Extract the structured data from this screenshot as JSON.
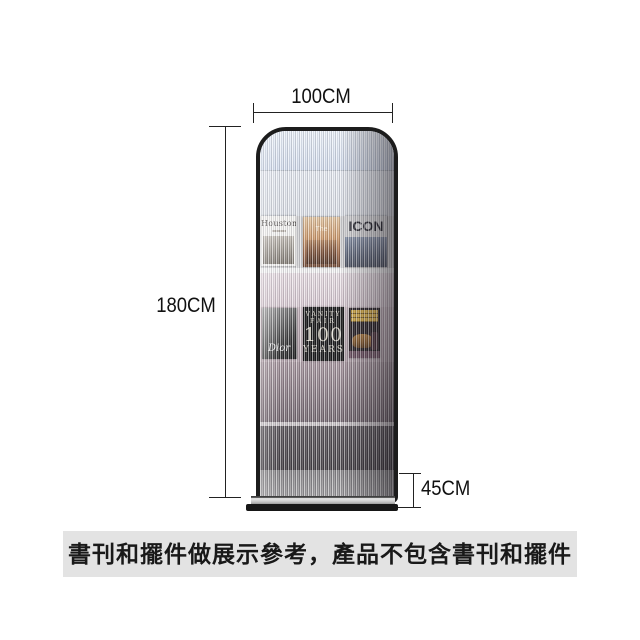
{
  "annotations": {
    "width_label": "100CM",
    "height_label": "180CM",
    "depth_label": "45CM"
  },
  "caption": {
    "text": "書刊和擺件做展示參考，產品不包含書刊和擺件",
    "background": "#e3e3e3"
  },
  "rack": {
    "type": "fluted-glass-magazine-display-rack",
    "frame_color": "#1c1c1c",
    "base_color": "#161616",
    "magazines": {
      "row1": [
        {
          "title": "Houston"
        },
        {
          "title": "The"
        },
        {
          "title": "ICON"
        }
      ],
      "row2": [
        {
          "title": "Dior"
        },
        {
          "line1": "VANITY",
          "line2": "FAIR",
          "line3": "100",
          "line4": "YEARS"
        },
        {
          "title": ""
        }
      ]
    }
  }
}
